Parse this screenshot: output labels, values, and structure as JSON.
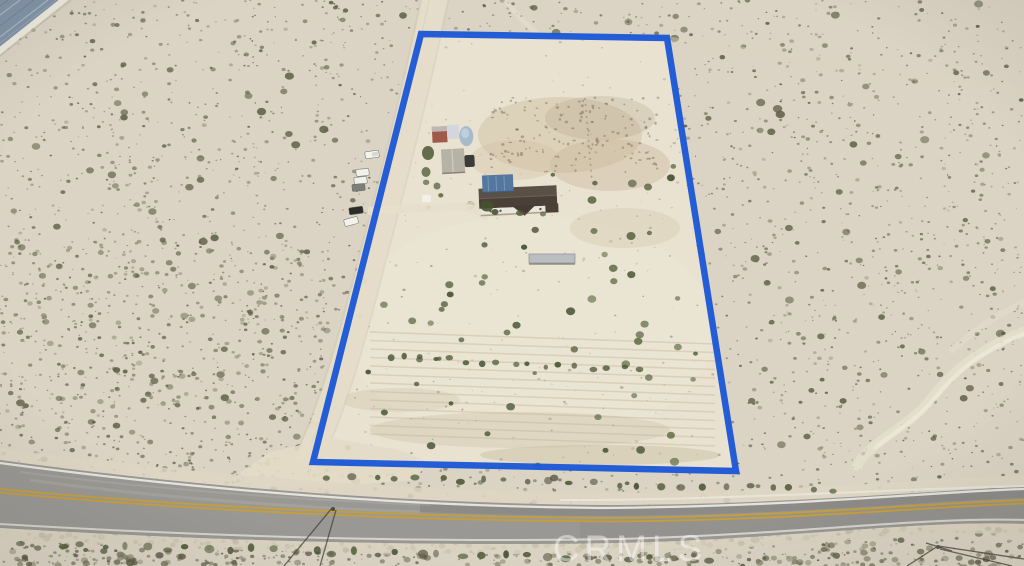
{
  "watermark": {
    "text": "CRMLS",
    "color": "#ffffff",
    "opacity": 0.45
  },
  "boundary": {
    "color": "#1d59d6",
    "stroke_width": 6.5,
    "shape": "four-corner property parcel outline"
  },
  "scene": {
    "type": "aerial-drone-photo",
    "setting": "desert residential parcel beside a two-lane highway",
    "features": {
      "house": "single-story house with dark gable roof and blue metal carport",
      "outbuildings": [
        "gray-roof shed",
        "red-brown shed",
        "white trailer",
        "light-blue tank"
      ],
      "vehicles_parked": 6,
      "paved_road": "two-lane road with double yellow center line and white edge lines",
      "dirt_road": "graded dirt road along west boundary",
      "solar_array": "edge of solar panel array visible in top-left corner",
      "vegetation": "scattered desert scrub and tilled garden rows"
    }
  },
  "palette": {
    "desert_ground": "#d7d0c0",
    "parcel_ground": "#e9e2d0",
    "scrub_dark": "#62624b",
    "scrub_olive": "#6e6e55",
    "bush_green": "#4d5a36",
    "road_asphalt": "#999894",
    "center_line": "#c79f3a",
    "dirt_road": "#e5ddc9",
    "house_roof": "#4a4037",
    "carport_blue": "#53779f",
    "solar_panel": "#8394a8"
  }
}
